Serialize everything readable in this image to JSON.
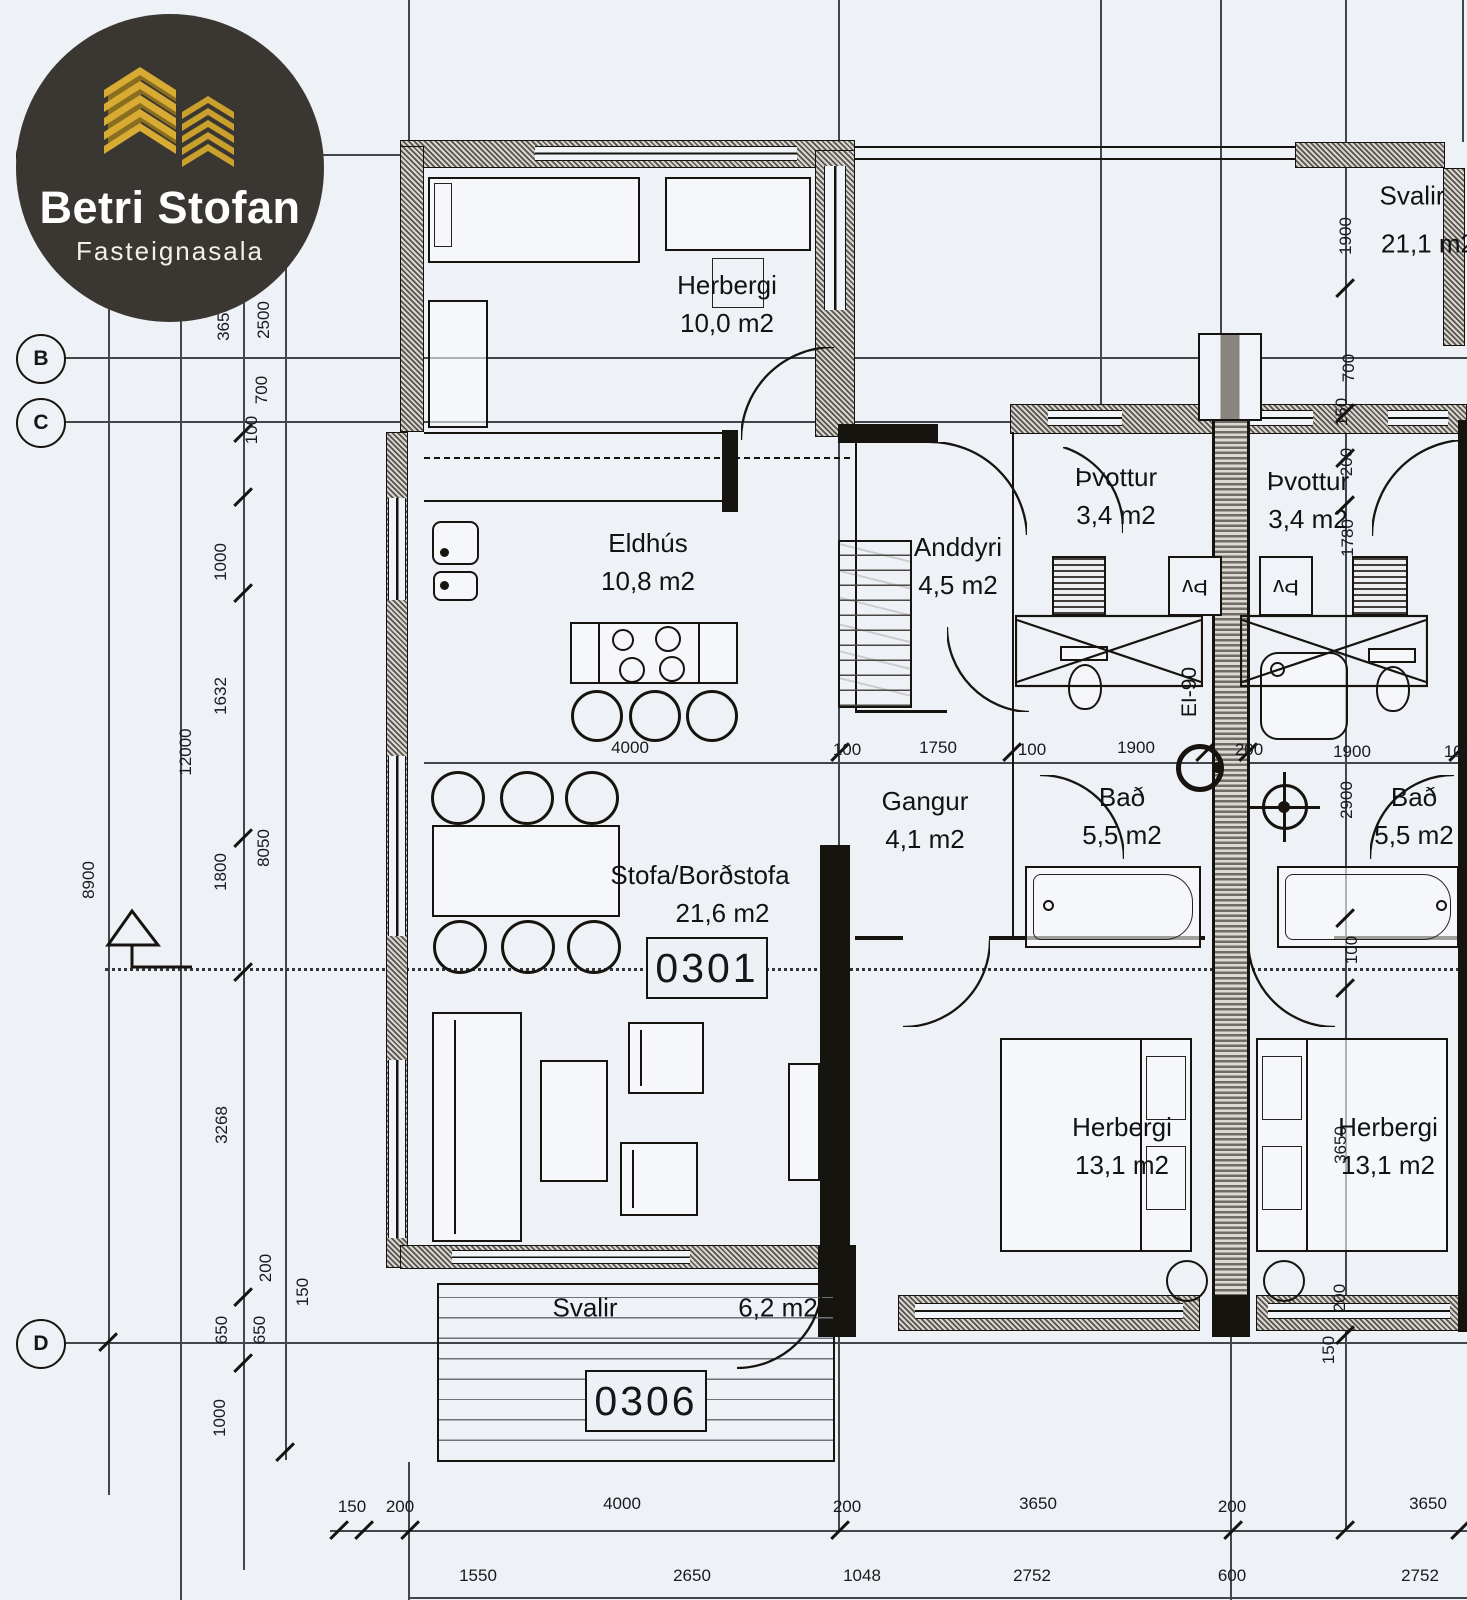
{
  "logo": {
    "title": "Betri Stofan",
    "subtitle": "Fasteignasala"
  },
  "units": [
    {
      "id": "0301"
    },
    {
      "id": "0306"
    }
  ],
  "rooms": [
    {
      "n": "Herbergi",
      "a": "10,0 m2",
      "x": 727,
      "y": 266
    },
    {
      "n": "Eldhús",
      "a": "10,8 m2",
      "x": 648,
      "y": 524
    },
    {
      "n": "Anddyri",
      "a": "4,5 m2",
      "x": 958,
      "y": 528
    },
    {
      "n": "Þvottur",
      "a": "3,4 m2",
      "x": 1116,
      "y": 458
    },
    {
      "n": "Þvottur",
      "a": "3,4 m2",
      "x": 1308,
      "y": 462
    },
    {
      "n": "Gangur",
      "a": "4,1 m2",
      "x": 925,
      "y": 782
    },
    {
      "n": "Bað",
      "a": "5,5 m2",
      "x": 1122,
      "y": 778
    },
    {
      "n": "Bað",
      "a": "5,5 m2",
      "x": 1414,
      "y": 778
    },
    {
      "n": "Stofa/Borðstofa",
      "a": "21,6 m2",
      "x": 700,
      "y": 856,
      "dx": 45
    },
    {
      "n": "Herbergi",
      "a": "13,1 m2",
      "x": 1122,
      "y": 1108
    },
    {
      "n": "Herbergi",
      "a": "13,1 m2",
      "x": 1388,
      "y": 1108
    }
  ],
  "texts": [
    {
      "t": "Svalir",
      "x": 1412,
      "y": 196,
      "k": 0,
      "s": 26
    },
    {
      "t": "21,1 m2",
      "x": 1428,
      "y": 244,
      "k": 0,
      "s": 26
    },
    {
      "t": "Svalir",
      "x": 585,
      "y": 1308,
      "k": 0,
      "s": 26
    },
    {
      "t": "6,2 m2",
      "x": 778,
      "y": 1308,
      "k": 0,
      "s": 26
    },
    {
      "t": "EI-90",
      "x": 1190,
      "y": 692,
      "k": 1,
      "s": 21
    },
    {
      "t": "Þv",
      "x": 1195,
      "y": 587,
      "k": 2,
      "s": 22
    },
    {
      "t": "Þv",
      "x": 1286,
      "y": 587,
      "k": 2,
      "s": 22
    }
  ],
  "grid_bubbles": [
    {
      "l": "A",
      "x": 41,
      "y": 156
    },
    {
      "l": "B",
      "x": 41,
      "y": 359
    },
    {
      "l": "C",
      "x": 41,
      "y": 423
    },
    {
      "l": "D",
      "x": 41,
      "y": 1344
    }
  ],
  "dimensions": [
    {
      "t": "1900",
      "x": 86,
      "y": 250,
      "r": 1
    },
    {
      "t": "150",
      "x": 256,
      "y": 104,
      "r": 1
    },
    {
      "t": "200",
      "x": 257,
      "y": 146,
      "r": 1
    },
    {
      "t": "3650",
      "x": 224,
      "y": 322,
      "r": 1
    },
    {
      "t": "2500",
      "x": 264,
      "y": 320,
      "r": 1
    },
    {
      "t": "700",
      "x": 262,
      "y": 390,
      "r": 1
    },
    {
      "t": "100",
      "x": 252,
      "y": 430,
      "r": 1
    },
    {
      "t": "1000",
      "x": 221,
      "y": 562,
      "r": 1
    },
    {
      "t": "1632",
      "x": 221,
      "y": 696,
      "r": 1
    },
    {
      "t": "12000",
      "x": 186,
      "y": 752,
      "r": 1
    },
    {
      "t": "8900",
      "x": 89,
      "y": 880,
      "r": 1
    },
    {
      "t": "1800",
      "x": 221,
      "y": 872,
      "r": 1
    },
    {
      "t": "8050",
      "x": 264,
      "y": 848,
      "r": 1
    },
    {
      "t": "3268",
      "x": 222,
      "y": 1125,
      "r": 1
    },
    {
      "t": "200",
      "x": 266,
      "y": 1268,
      "r": 1
    },
    {
      "t": "150",
      "x": 303,
      "y": 1292,
      "r": 1
    },
    {
      "t": "650",
      "x": 222,
      "y": 1330,
      "r": 1
    },
    {
      "t": "650",
      "x": 260,
      "y": 1330,
      "r": 1
    },
    {
      "t": "1000",
      "x": 220,
      "y": 1418,
      "r": 1
    },
    {
      "t": "1900",
      "x": 1346,
      "y": 236,
      "r": 1
    },
    {
      "t": "700",
      "x": 1349,
      "y": 368,
      "r": 1
    },
    {
      "t": "150",
      "x": 1342,
      "y": 412,
      "r": 1
    },
    {
      "t": "200",
      "x": 1347,
      "y": 462,
      "r": 1
    },
    {
      "t": "1780",
      "x": 1348,
      "y": 538,
      "r": 1
    },
    {
      "t": "2900",
      "x": 1347,
      "y": 800,
      "r": 1
    },
    {
      "t": "100",
      "x": 1352,
      "y": 950,
      "r": 1
    },
    {
      "t": "3650",
      "x": 1341,
      "y": 1145,
      "r": 1
    },
    {
      "t": "200",
      "x": 1340,
      "y": 1298,
      "r": 1
    },
    {
      "t": "150",
      "x": 1329,
      "y": 1350,
      "r": 1
    },
    {
      "t": "4000",
      "x": 630,
      "y": 748,
      "r": 0
    },
    {
      "t": "100",
      "x": 847,
      "y": 750,
      "r": 0
    },
    {
      "t": "1750",
      "x": 938,
      "y": 748,
      "r": 0
    },
    {
      "t": "100",
      "x": 1032,
      "y": 750,
      "r": 0
    },
    {
      "t": "1900",
      "x": 1136,
      "y": 748,
      "r": 0
    },
    {
      "t": "200",
      "x": 1249,
      "y": 750,
      "r": 0
    },
    {
      "t": "1900",
      "x": 1352,
      "y": 752,
      "r": 0
    },
    {
      "t": "100",
      "x": 1458,
      "y": 752,
      "r": 0
    },
    {
      "t": "150",
      "x": 352,
      "y": 1507,
      "r": 0
    },
    {
      "t": "200",
      "x": 400,
      "y": 1507,
      "r": 0
    },
    {
      "t": "4000",
      "x": 622,
      "y": 1504,
      "r": 0
    },
    {
      "t": "200",
      "x": 847,
      "y": 1507,
      "r": 0
    },
    {
      "t": "3650",
      "x": 1038,
      "y": 1504,
      "r": 0
    },
    {
      "t": "200",
      "x": 1232,
      "y": 1507,
      "r": 0
    },
    {
      "t": "3650",
      "x": 1428,
      "y": 1504,
      "r": 0
    },
    {
      "t": "1550",
      "x": 478,
      "y": 1576,
      "r": 0
    },
    {
      "t": "2650",
      "x": 692,
      "y": 1576,
      "r": 0
    },
    {
      "t": "1048",
      "x": 862,
      "y": 1576,
      "r": 0
    },
    {
      "t": "2752",
      "x": 1032,
      "y": 1576,
      "r": 0
    },
    {
      "t": "600",
      "x": 1232,
      "y": 1576,
      "r": 0
    },
    {
      "t": "2752",
      "x": 1420,
      "y": 1576,
      "r": 0
    }
  ],
  "ticks": [
    [
      339,
      1530
    ],
    [
      364,
      1530
    ],
    [
      410,
      1530
    ],
    [
      840,
      1530
    ],
    [
      1233,
      1530
    ],
    [
      1345,
      1530
    ],
    [
      1460,
      1530
    ],
    [
      243,
      433
    ],
    [
      243,
      497
    ],
    [
      243,
      593
    ],
    [
      243,
      838
    ],
    [
      243,
      972
    ],
    [
      243,
      1297
    ],
    [
      243,
      1363
    ],
    [
      285,
      1452
    ],
    [
      108,
      1342
    ],
    [
      1345,
      288
    ],
    [
      1345,
      413
    ],
    [
      1345,
      458
    ],
    [
      1345,
      505
    ],
    [
      1345,
      918
    ],
    [
      1345,
      988
    ],
    [
      1345,
      1335
    ],
    [
      840,
      752
    ],
    [
      1012,
      752
    ],
    [
      1205,
      752
    ],
    [
      1248,
      752
    ],
    [
      1458,
      752
    ],
    [
      262,
      112
    ],
    [
      262,
      160
    ]
  ]
}
